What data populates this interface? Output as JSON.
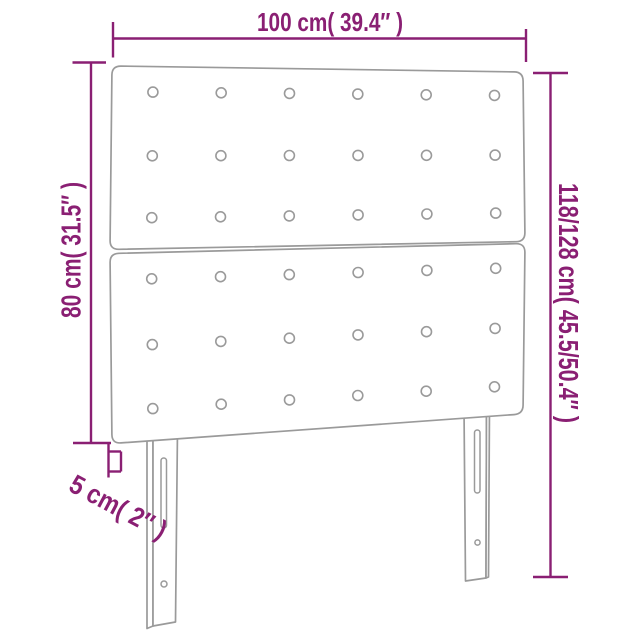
{
  "diagram": {
    "product": "headboard-with-tufted-buttons-and-legs",
    "labels": {
      "width": "100 cm( 39.4″ )",
      "total_height": "118/128 cm( 45.5/50.4″ )",
      "board_height": "80 cm( 31.5″ )",
      "thickness": "5 cm( 2″ )"
    },
    "colors": {
      "dimension": "#8a1f73",
      "outline": "#9a9a9a"
    },
    "tufting": {
      "panels": 2,
      "rows_per_panel": 3,
      "columns": 6
    }
  }
}
